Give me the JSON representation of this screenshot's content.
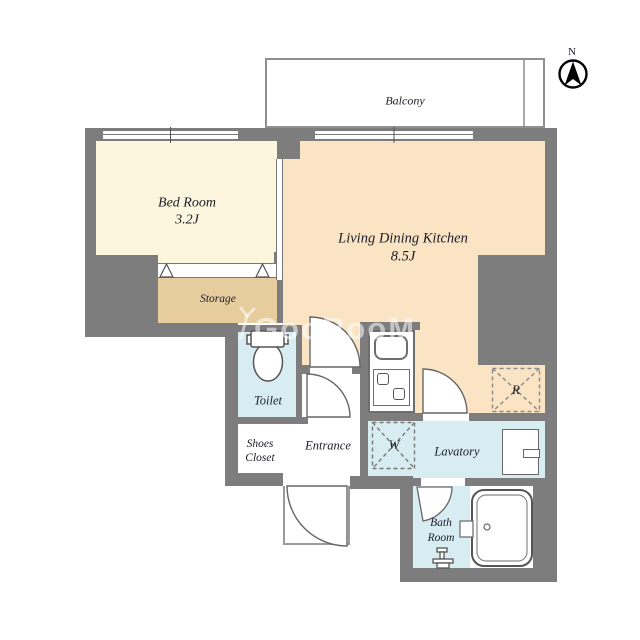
{
  "compass": {
    "label": "N"
  },
  "watermark": {
    "text": "GooRooM"
  },
  "rooms": {
    "balcony": {
      "label": "Balcony"
    },
    "bedroom": {
      "label": "Bed Room",
      "size": "3.2J"
    },
    "ldk": {
      "label": "Living Dining Kitchen",
      "size": "8.5J"
    },
    "storage": {
      "label": "Storage"
    },
    "toilet": {
      "label": "Toilet"
    },
    "shoes_closet": {
      "label_line1": "Shoes",
      "label_line2": "Closet"
    },
    "entrance": {
      "label": "Entrance"
    },
    "lavatory": {
      "label": "Lavatory"
    },
    "bathroom": {
      "label_line1": "Bath",
      "label_line2": "Room"
    },
    "washing_machine": {
      "label": "W"
    },
    "refrigerator": {
      "label": "R"
    }
  },
  "colors": {
    "wall": "#7d7d7d",
    "bedroom_floor": "#fbf6dd",
    "storage_floor": "#e7cc9d",
    "ldk_floor": "#fae4c3",
    "wet_area_floor": "#d8edf2",
    "fixture_outline": "#666666",
    "label_text": "#1c1c28"
  }
}
